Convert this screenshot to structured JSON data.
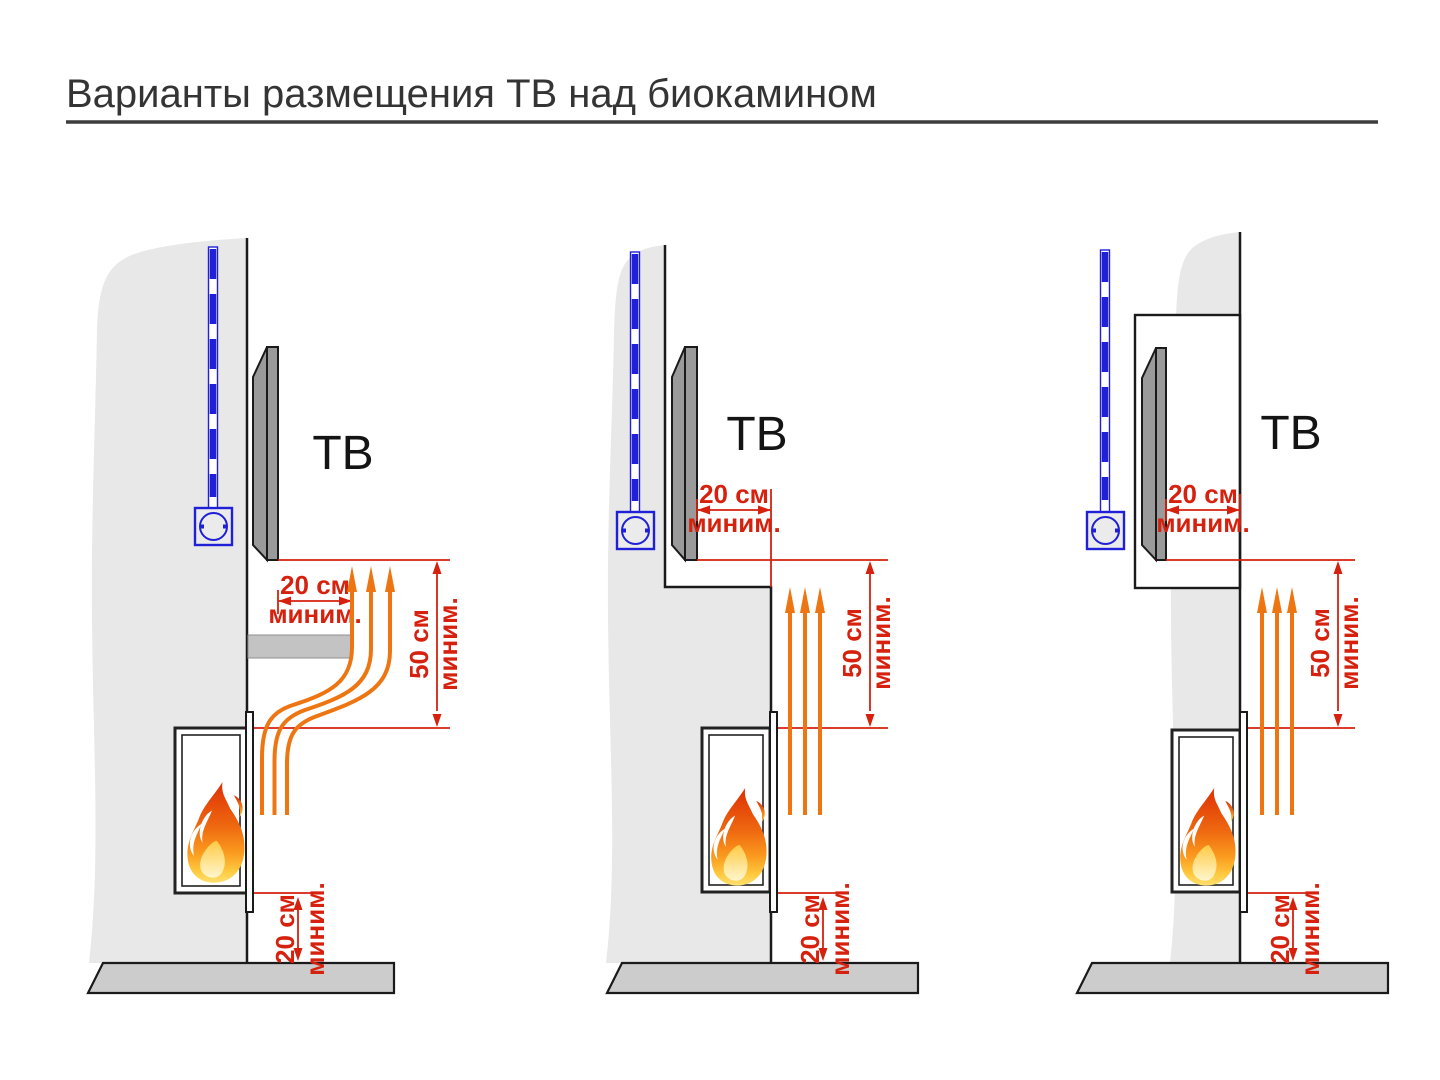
{
  "title": {
    "text": "Варианты размещения ТВ над биокамином"
  },
  "colors": {
    "accent_red": "#d6210e",
    "accent_orange": "#ee7612",
    "accent_blue": "#2020d6",
    "wall_gray": "#e8e8e8",
    "floor_gray": "#cccccc",
    "tv_gray": "#9a9a9a"
  },
  "diagrams": [
    {
      "id": "tv-over-shelf",
      "tv_label": "ТВ",
      "side_gap_value": "20 см",
      "side_gap_qualifier": "миним.",
      "top_gap_value": "50 см",
      "top_gap_qualifier": "миним.",
      "bottom_gap_value": "20 см",
      "bottom_gap_qualifier": "миним."
    },
    {
      "id": "tv-on-recessed-wall",
      "tv_label": "ТВ",
      "side_gap_value": "20 см",
      "side_gap_qualifier": "миним.",
      "top_gap_value": "50 см",
      "top_gap_qualifier": "миним.",
      "bottom_gap_value": "20 см",
      "bottom_gap_qualifier": "миним."
    },
    {
      "id": "tv-in-niche",
      "tv_label": "ТВ",
      "side_gap_value": "20 см",
      "side_gap_qualifier": "миним.",
      "top_gap_value": "50 см",
      "top_gap_qualifier": "миним.",
      "bottom_gap_value": "20 см",
      "bottom_gap_qualifier": "миним."
    }
  ]
}
